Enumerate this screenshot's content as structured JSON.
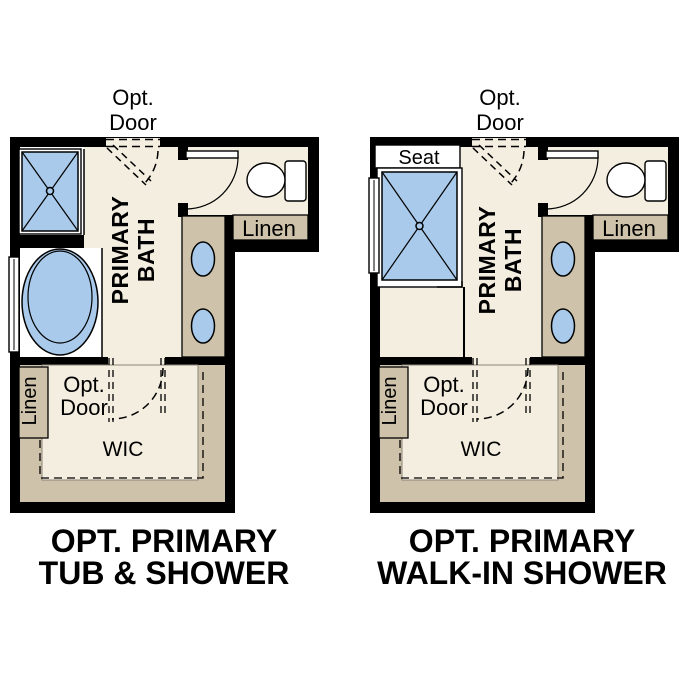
{
  "colors": {
    "wall": "#000000",
    "floor": "#F4EEE1",
    "cabinet": "#CEC3AA",
    "fixture_blue": "#A9CAEA",
    "white": "#FFFFFF",
    "label_text": "#000000"
  },
  "plans": [
    {
      "id": "opt-primary-tub-shower",
      "caption": [
        "OPT. PRIMARY",
        "TUB & SHOWER"
      ],
      "labels": {
        "opt_door_top_line1": "Opt.",
        "opt_door_top_line2": "Door",
        "room_line1": "PRIMARY",
        "room_line2": "BATH",
        "linen_upper": "Linen",
        "linen_lower": "Linen",
        "opt_door_lower_line1": "Opt.",
        "opt_door_lower_line2": "Door",
        "closet": "WIC"
      }
    },
    {
      "id": "opt-primary-walk-in-shower",
      "caption": [
        "OPT. PRIMARY",
        "WALK-IN SHOWER"
      ],
      "labels": {
        "seat": "Seat",
        "opt_door_top_line1": "Opt.",
        "opt_door_top_line2": "Door",
        "room_line1": "PRIMARY",
        "room_line2": "BATH",
        "linen_upper": "Linen",
        "linen_lower": "Linen",
        "opt_door_lower_line1": "Opt.",
        "opt_door_lower_line2": "Door",
        "closet": "WIC"
      }
    }
  ]
}
